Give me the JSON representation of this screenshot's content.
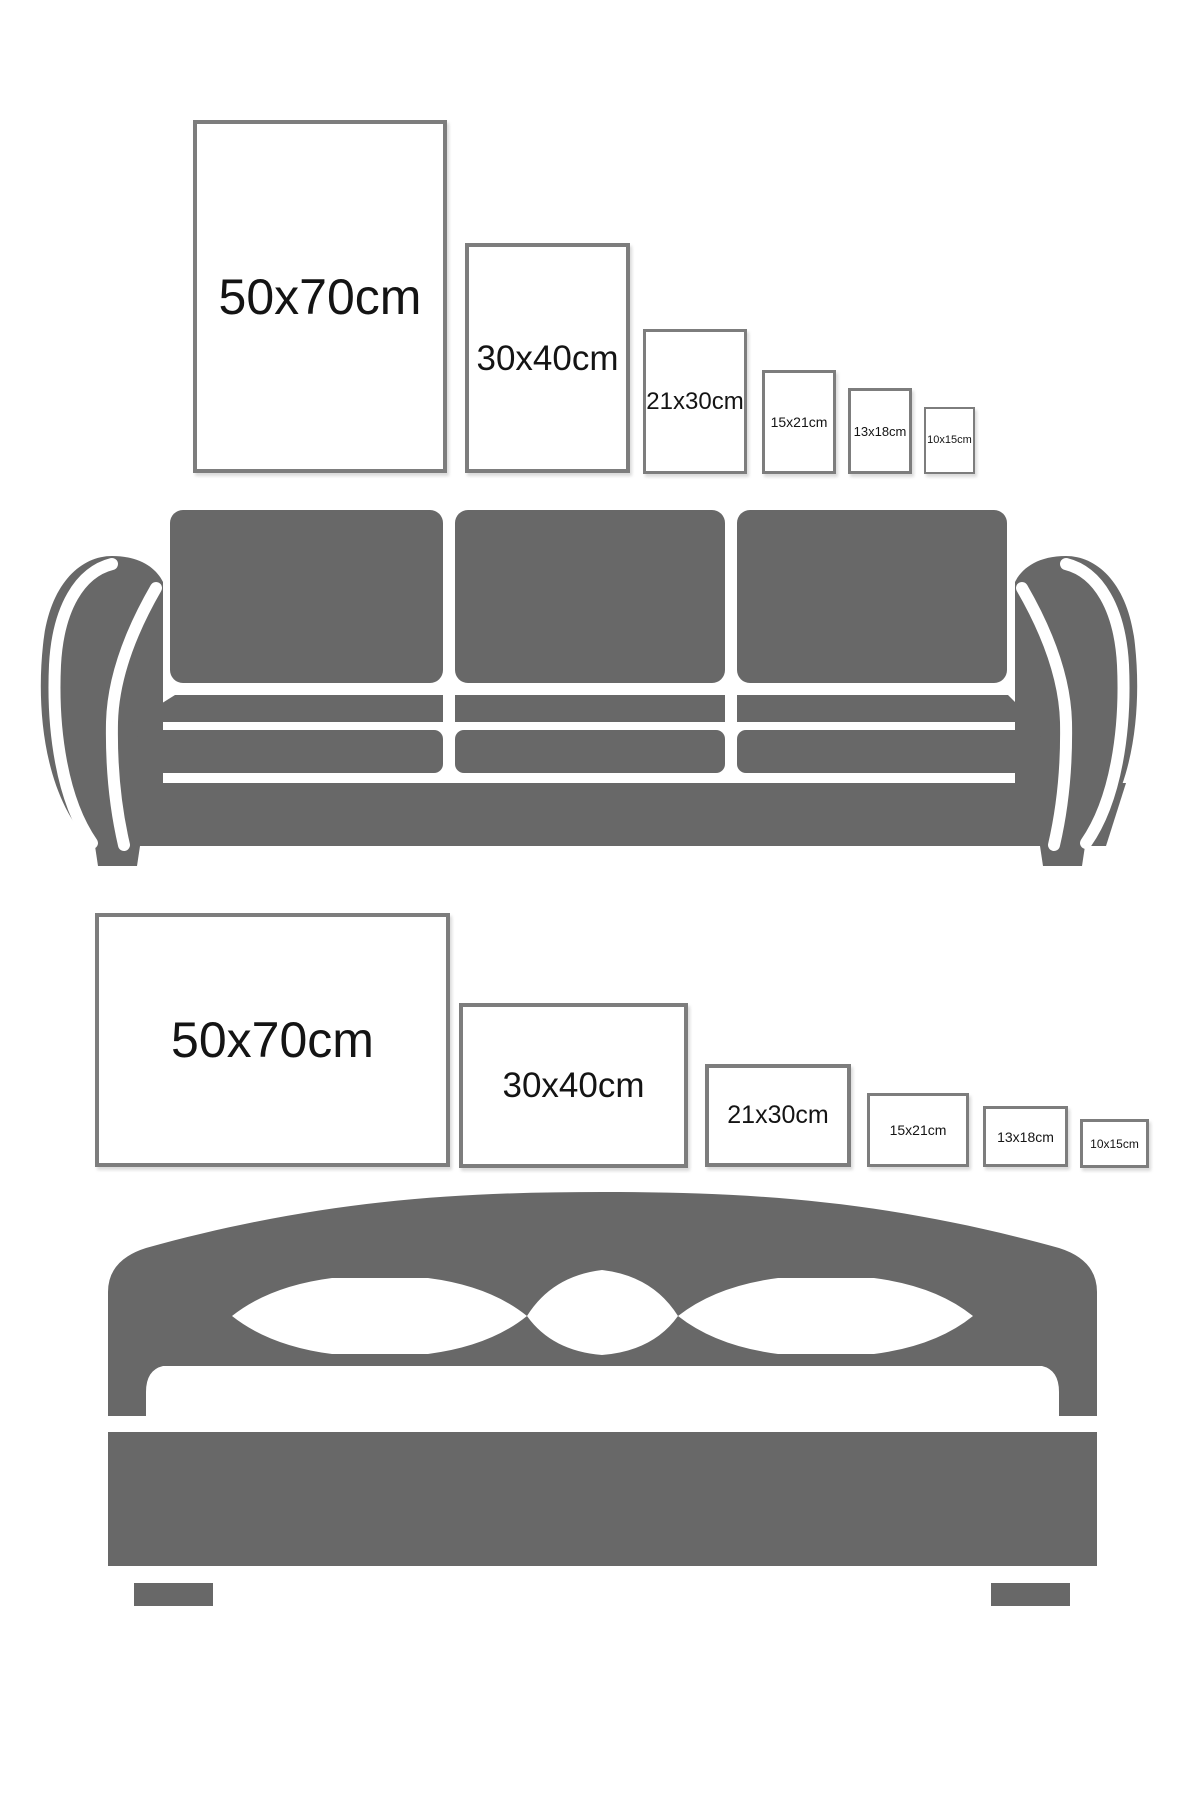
{
  "diagram": {
    "title": "Poster frame size comparison",
    "sizes_cm": [
      "50x70",
      "30x40",
      "21x30",
      "15x21",
      "13x18",
      "10x15"
    ]
  },
  "colors": {
    "background": "#ffffff",
    "furniture_gray": "#686868",
    "frame_border_gray": "#7d7d7d",
    "label_black": "#141414"
  },
  "sections": [
    {
      "id": "sofa-wall",
      "furniture": "sofa",
      "orientation": "portrait",
      "frames": [
        {
          "label": "50x70cm"
        },
        {
          "label": "30x40cm"
        },
        {
          "label": "21x30cm"
        },
        {
          "label": "15x21cm"
        },
        {
          "label": "13x18cm"
        },
        {
          "label": "10x15cm"
        }
      ]
    },
    {
      "id": "bed-wall",
      "furniture": "bed",
      "orientation": "landscape",
      "frames": [
        {
          "label": "50x70cm"
        },
        {
          "label": "30x40cm"
        },
        {
          "label": "21x30cm"
        },
        {
          "label": "15x21cm"
        },
        {
          "label": "13x18cm"
        },
        {
          "label": "10x15cm"
        }
      ]
    }
  ]
}
